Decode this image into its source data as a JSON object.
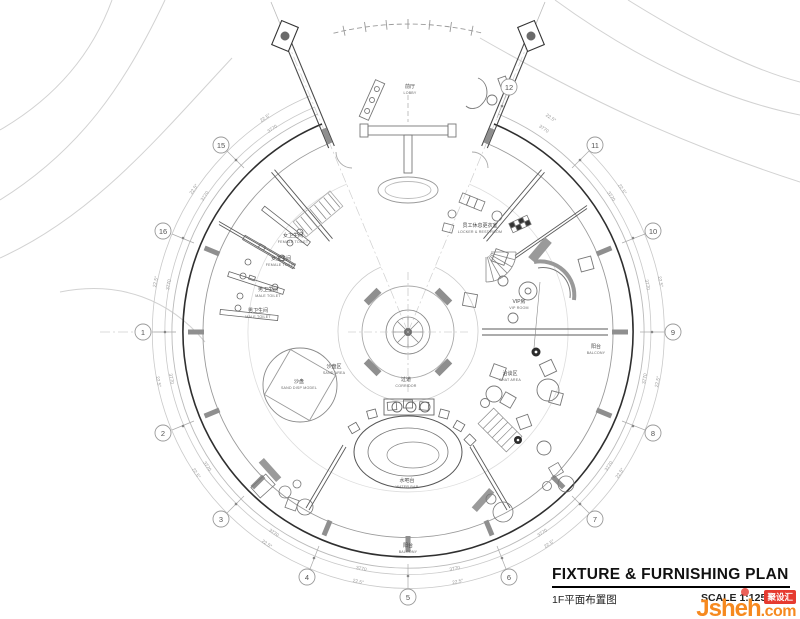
{
  "title_block": {
    "title": "FIXTURE & FURNISHING PLAN",
    "subtitle_zh": "1F平面布置图",
    "scale": "SCALE  1:125@A2"
  },
  "logo": {
    "name": "Jsheh",
    "tld": ".com",
    "badge": "聚设汇"
  },
  "colors": {
    "brand_orange": "#f6891f",
    "brand_red": "#e63a30",
    "line_dark": "#2f2f2f",
    "line_light": "#c9c9c9"
  },
  "plan": {
    "dims": {
      "segment_length": "3770",
      "segment_angle": "22.5°"
    },
    "grid_bubbles": [
      "1",
      "2",
      "3",
      "4",
      "5",
      "6",
      "7",
      "8",
      "9",
      "10",
      "11",
      "12",
      "13",
      "14",
      "15",
      "16"
    ],
    "rooms": {
      "lobby": {
        "zh": "前厅",
        "en": "LOBBY"
      },
      "locker": {
        "zh": "员工休息更衣室",
        "en": "LOCKER & REST ROOM"
      },
      "female_toilet": {
        "zh": "女卫生间",
        "en": "FEMALE TOILET"
      },
      "female_toilet2": {
        "zh": "女卫生间",
        "en": "FEMALE TOILET"
      },
      "male_toilet": {
        "zh": "男卫生间",
        "en": "MALE TOILET"
      },
      "male_toilet2": {
        "zh": "男卫生间",
        "en": "MALE TOILET"
      },
      "vip": {
        "zh": "VIP房",
        "en": "VIP ROOM"
      },
      "sand_area": {
        "zh": "沙盘区",
        "en": "SAND AREA"
      },
      "sand_model": {
        "zh": "沙盘",
        "en": "SAND DISP MODEL"
      },
      "corridor": {
        "zh": "过道",
        "en": "CORRIDOR"
      },
      "chat": {
        "zh": "洽谈区",
        "en": "CHAT AREA"
      },
      "water_bar": {
        "zh": "水吧台",
        "en": "WATER BAR"
      },
      "balcony_right": {
        "zh": "阳台",
        "en": "BALCONY"
      },
      "balcony_bottom": {
        "zh": "阳台",
        "en": "BALCONY"
      }
    }
  }
}
